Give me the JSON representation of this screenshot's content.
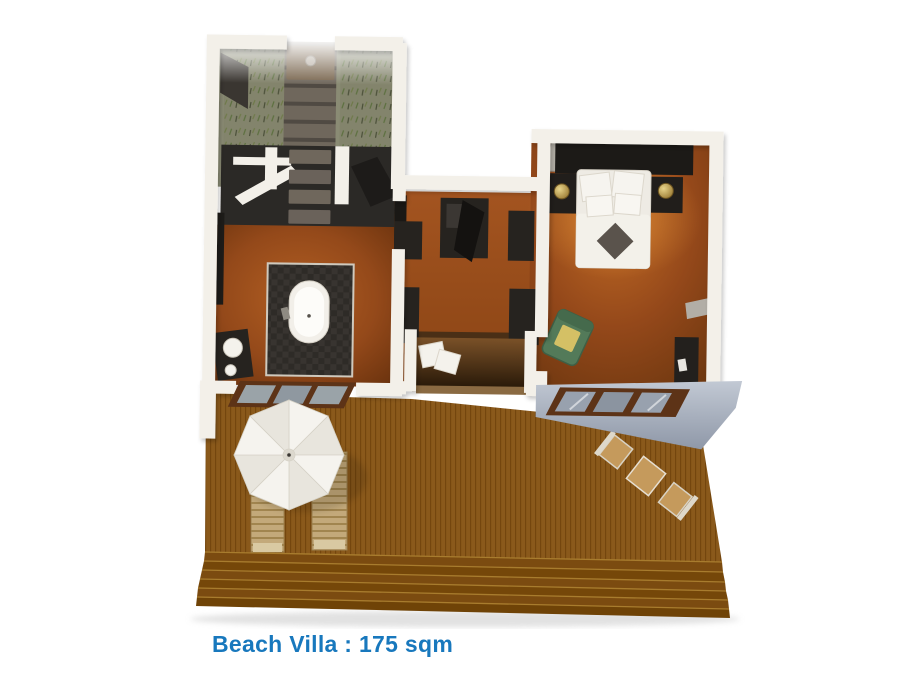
{
  "caption": {
    "text": "Beach Villa : 175 sqm",
    "color": "#1878bd"
  },
  "colors": {
    "background": "#ffffff",
    "deck_wood": "#8a591b",
    "deck_plank_stripe": "#74460e",
    "deck_step": "#7b4b10",
    "step_highlight": "#a87c2e",
    "wall_white": "#f3f0e9",
    "floor_terracotta": "#9c4e1d",
    "dark_fixture": "#26231f",
    "grass_olive": "#83846c",
    "grass_tuft_green": "#5d7040",
    "stone_path": "#6f675c",
    "umbrella_white": "#f5f3ee",
    "umbrella_shade": "#e8e5dd",
    "lounger_wood": "#c3a97a",
    "table_wood": "#c59a5c",
    "armchair_green": "#537a59",
    "cushion_yellow": "#d4c065",
    "bed_linen": "#eeebe4",
    "lamp_brass": "#c8ab5e",
    "glass_gray": "#9aa3a8",
    "door_frame_brown": "#5d3317",
    "bathtub_white": "#f2efe9",
    "wall_face_blue_top": "#c2c9d4",
    "wall_face_blue_bottom": "#8f98a8"
  }
}
